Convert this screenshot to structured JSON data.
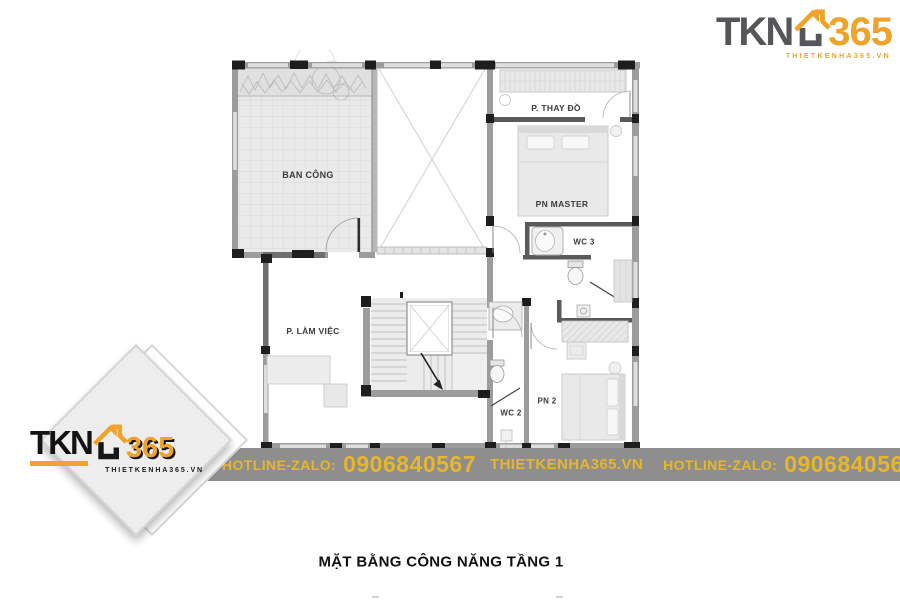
{
  "brand": {
    "tkn": "TKN",
    "n365": "365",
    "tagline": "THIETKENHA365.VN",
    "orange": "#f0a32b",
    "gray": "#55565a"
  },
  "banner": {
    "bg": "#8e8e8e",
    "text_color": "#e8b62a",
    "items": [
      {
        "text": "HOTLINE-ZALO:"
      },
      {
        "text": "0906840567"
      },
      {
        "text": "THIETKENHA365.VN"
      },
      {
        "text": "HOTLINE-ZALO:"
      },
      {
        "text": "0906840567"
      }
    ]
  },
  "plan": {
    "rooms": [
      {
        "id": "ban-cong",
        "label": "BAN CÔNG"
      },
      {
        "id": "p-thay-do",
        "label": "P. THAY ĐỒ"
      },
      {
        "id": "pn-master",
        "label": "PN MASTER"
      },
      {
        "id": "wc-3",
        "label": "WC 3"
      },
      {
        "id": "p-lam-viec",
        "label": "P. LÀM VIỆC"
      },
      {
        "id": "wc-2",
        "label": "WC 2"
      },
      {
        "id": "pn-2",
        "label": "PN 2"
      }
    ]
  },
  "title": "MẶT BẰNG CÔNG NĂNG TẦNG 1"
}
